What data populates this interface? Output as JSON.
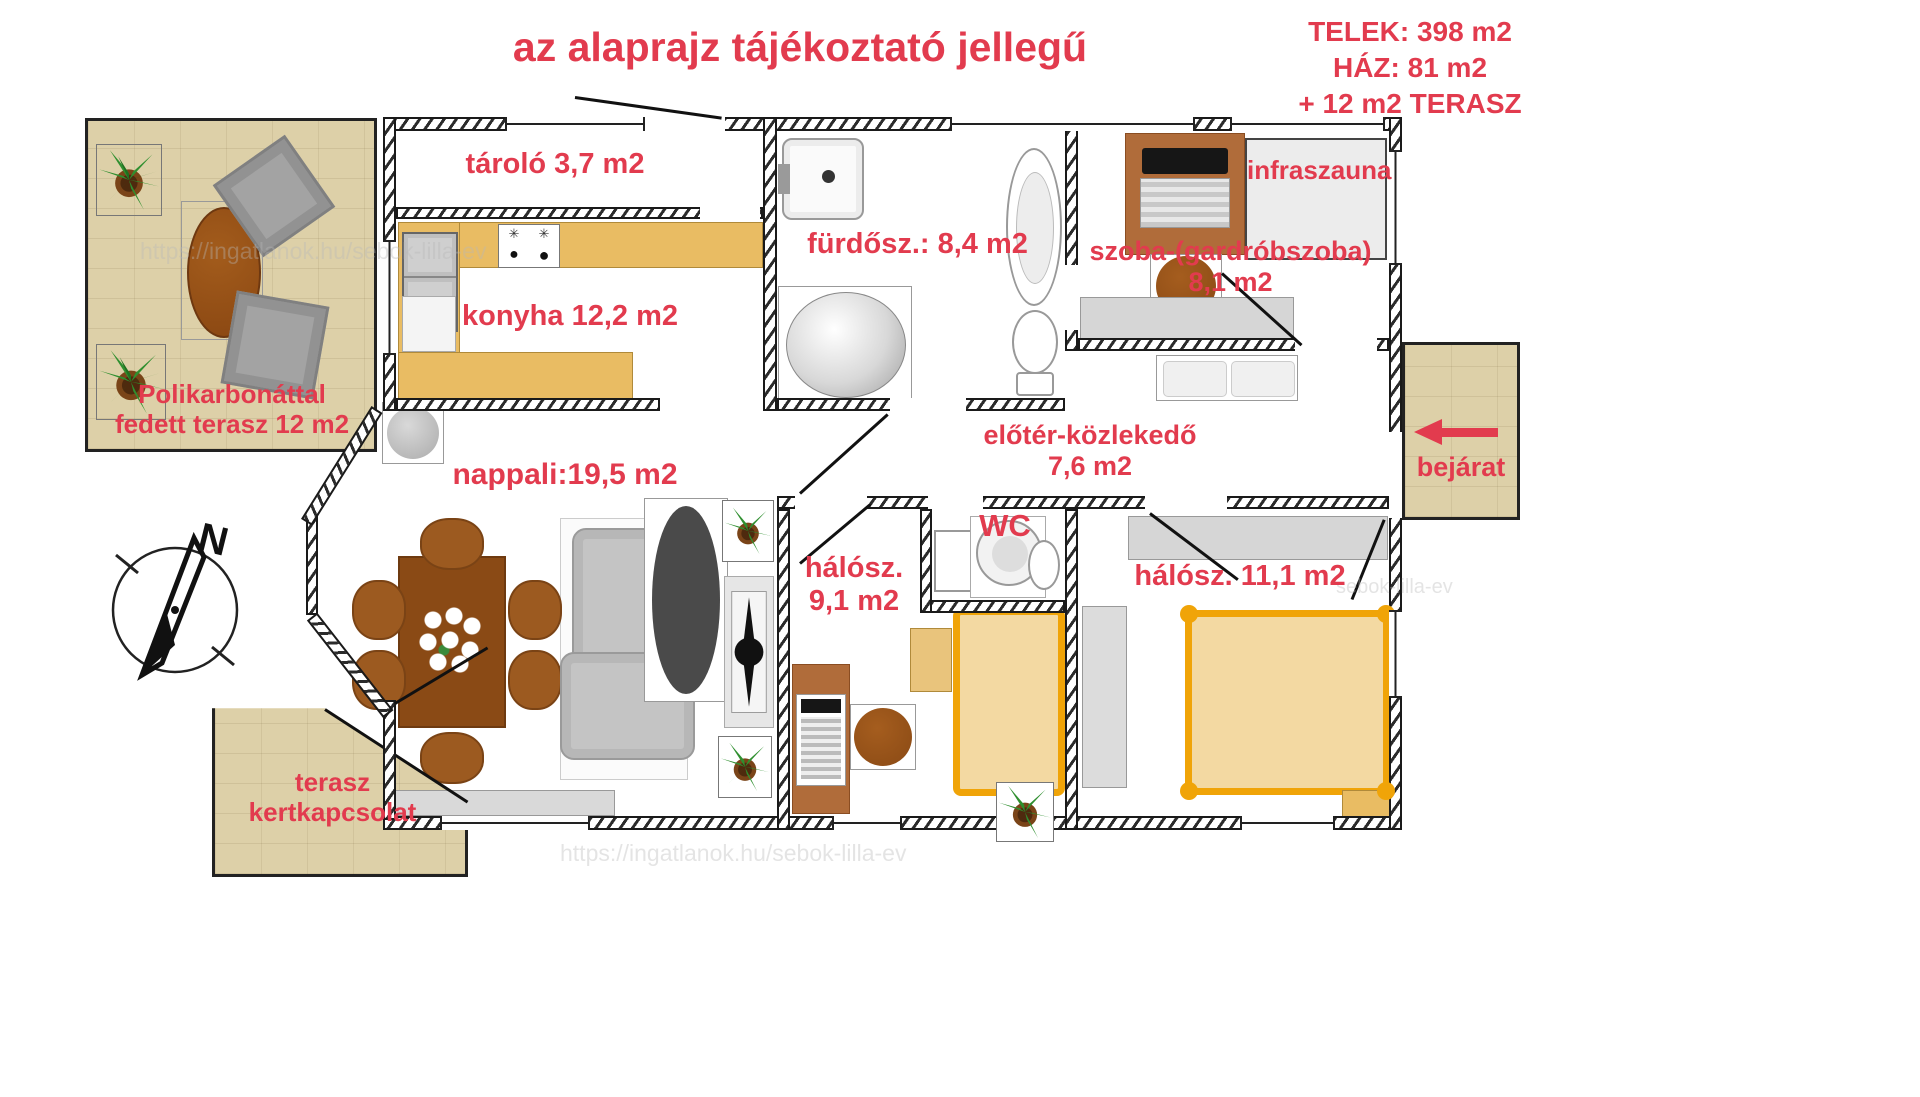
{
  "title": "az alaprajz tájékoztató jellegű",
  "info": {
    "telek": "TELEK: 398 m2",
    "haz": "HÁZ: 81 m2",
    "terasz": "+ 12 m2 TERASZ"
  },
  "rooms": {
    "fedett_terasz_1": "Polikarbonáttal",
    "fedett_terasz_2": "fedett terasz 12 m2",
    "tarolo": "tároló 3,7 m2",
    "konyha": "konyha 12,2 m2",
    "furdo": "fürdősz.: 8,4 m2",
    "infraszauna": "infraszauna",
    "szoba_1": "szoba-(gardróbszoba)",
    "szoba_2": "8,1 m2",
    "nappali": "nappali:19,5 m2",
    "eloter_1": "előtér-közlekedő",
    "eloter_2": "7,6 m2",
    "wc": "WC",
    "halo1_1": "hálósz.",
    "halo1_2": "9,1 m2",
    "halo2": "hálósz. 11,1 m2",
    "bejarat": "bejárat",
    "terasz_kert_1": "terasz",
    "terasz_kert_2": "kertkapcsolat"
  },
  "compass": {
    "north": "N"
  },
  "watermarks": [
    "https://ingatlanok.hu/sebok-lilla-ev",
    "https://ingatlanok.hu/sebok-lilla-ev",
    "sebok-lilla-ev"
  ],
  "colors": {
    "label_red": "#e23b4e",
    "terrace_tan": "#ddd0a8",
    "counter_gold": "#e9bc63",
    "bed_frame": "#f0a408",
    "bed_fill": "#f3d9a2",
    "furniture_brown": "#9c5a20",
    "wall_dark": "#1a1a1a"
  }
}
